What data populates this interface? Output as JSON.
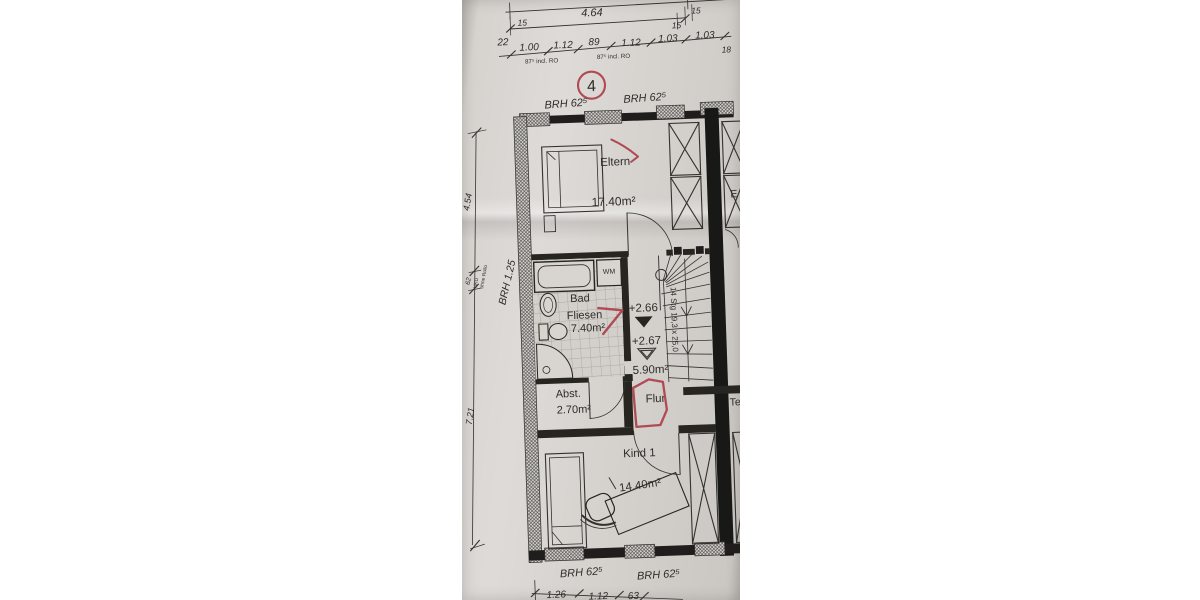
{
  "photo": {
    "top_dims": {
      "overall": "4.64",
      "wall_ticks": [
        "15",
        "15",
        "15"
      ],
      "left_seg": "22",
      "chain": [
        "1.00",
        "1.12",
        "89",
        "1.12",
        "1.03",
        "1.03"
      ],
      "incl_ro": [
        "87⁵ incl. RO",
        "87⁵ incl. RO"
      ],
      "right_partial": "18"
    },
    "red_annotations": {
      "circled_number": "4"
    },
    "brh_top": [
      "BRH 62⁵",
      "BRH 62⁵"
    ],
    "rooms": {
      "eltern": {
        "name": "Eltern",
        "area": "17.40m²"
      },
      "bad": {
        "name": "Bad",
        "floor": "Fliesen",
        "area": "7.40m²"
      },
      "abst": {
        "name": "Abst.",
        "area": "2.70m²"
      },
      "flur": {
        "name": "Flur",
        "area": "5.90m²"
      },
      "kind": {
        "name": "Kind 1",
        "area": "14.40m²"
      }
    },
    "stairs": {
      "label": "14 Stg 19,3 x 25,0",
      "level_upper": "+2.66",
      "level_lower": "+2.67"
    },
    "appliances": {
      "wm": "WM"
    },
    "left_dims": {
      "upper": "4.54",
      "window": "62",
      "ukd": "UKD",
      "ohne_rollo": "ohne Rollo",
      "brh": "BRH 1.25",
      "lower": "7.21"
    },
    "brh_bottom": [
      "BRH 62⁵",
      "BRH 62⁵"
    ],
    "bottom_dims": {
      "chain": [
        "1.26",
        "1.12",
        "63"
      ]
    },
    "neighbor": {
      "partial_top": "E",
      "partial_mid": "Te"
    }
  }
}
